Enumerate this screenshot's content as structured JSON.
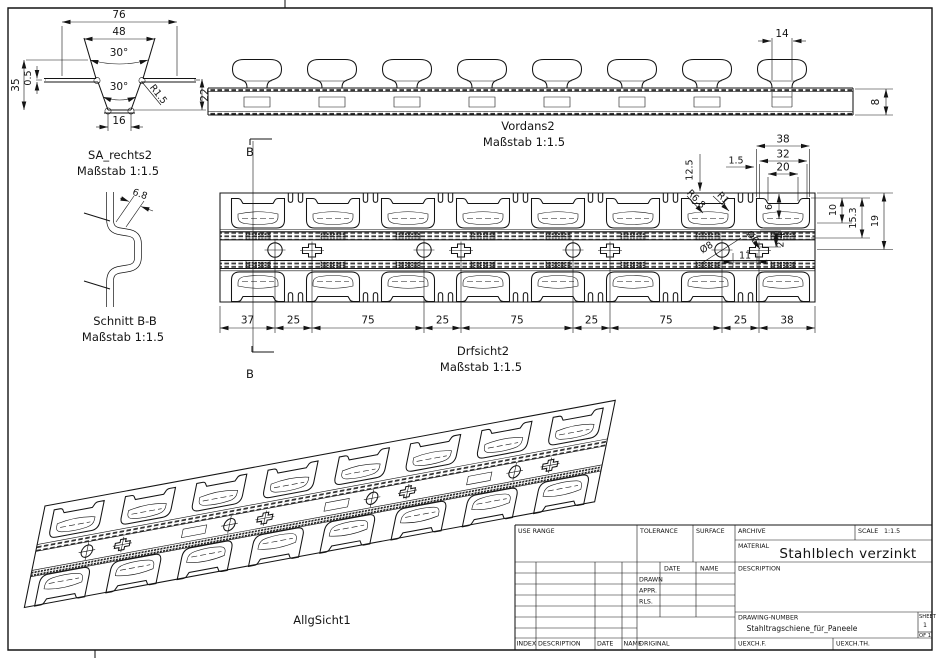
{
  "drawing": {
    "views": {
      "profile": {
        "title": "SA_rechts2",
        "scale_note": "Maßstab 1:1.5",
        "dims": {
          "d76": "76",
          "d48": "48",
          "a30t": "30°",
          "a30b": "30°",
          "d35": "35",
          "d05": "0.5",
          "r15": "R1.5",
          "d22": "22",
          "d16": "16"
        }
      },
      "section": {
        "title": "Schnitt B-B",
        "scale_note": "Maßstab 1:1.5",
        "dims": {
          "d68": "6.8"
        }
      },
      "front": {
        "title": "Vordans2",
        "scale_note": "Maßstab 1:1.5",
        "marker_b": "B",
        "dims": {
          "d14": "14",
          "d8": "8"
        }
      },
      "plan": {
        "title": "Drfsicht2",
        "scale_note": "Maßstab 1:1.5",
        "marker_b": "B",
        "chain": [
          "37",
          "25",
          "75",
          "25",
          "75",
          "25",
          "75",
          "25",
          "38"
        ],
        "dims": {
          "d38": "38",
          "d32": "32",
          "d20": "20",
          "d15": "1.5",
          "d125": "12.5",
          "d6": "6",
          "d10": "10",
          "d153": "15.3",
          "d19": "19",
          "r68": "R6.8",
          "r1": "R1",
          "dia8": "Ø8",
          "dia6": "Ø6",
          "d24": "2.4",
          "d11": "11"
        }
      },
      "iso": {
        "title": "AllgSicht1"
      }
    },
    "title_block": {
      "use_range": "USE RANGE",
      "tolerance": "TOLERANCE",
      "surface": "SURFACE",
      "archive": "ARCHIVE",
      "scale_label": "SCALE",
      "scale_value": "1:1.5",
      "material_label": "MATERIAL",
      "material_value": "Stahlblech verzinkt",
      "date_label": "DATE",
      "name_label": "NAME",
      "drawn": "DRAWN",
      "appr": "APPR.",
      "rls": "RLS.",
      "description": "DESCRIPTION",
      "drawing_number_label": "DRAWING-NUMBER",
      "drawing_number": "Stahltragschiene_für_Paneele",
      "sheet_label": "SHEET",
      "sheet_value": "1",
      "of_value": "OF 1",
      "index": "INDEX",
      "description_bottom": "DESCRIPTION",
      "date_bottom": "DATE",
      "name_bottom": "NAME",
      "original": "ORIGINAL",
      "uexchf": "UEXCH.F.",
      "uexchth": "UEXCH.TH."
    }
  }
}
